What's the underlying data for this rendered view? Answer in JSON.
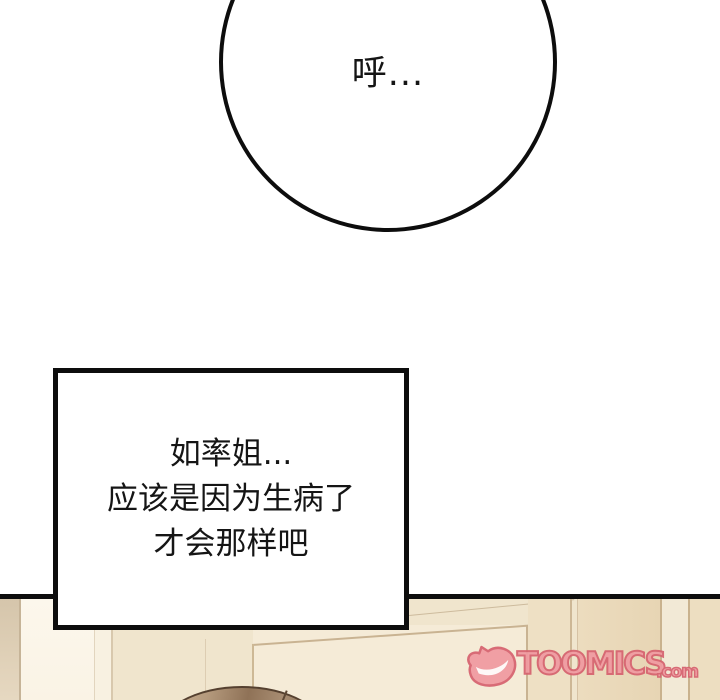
{
  "page": {
    "kind": "webtoon-comic-panel"
  },
  "panels": {
    "top": {
      "bubble_text": "呼..."
    }
  },
  "speech_box": {
    "lines": [
      "如率姐...",
      "应该是因为生病了",
      "才会那样吧"
    ]
  },
  "watermark": {
    "brand": "TOOMICS",
    "suffix": ".com",
    "icon": "toomics-d-smile-icon",
    "fill_color": "#f09aa1",
    "outline_color": "#d6626f"
  },
  "colors": {
    "ink": "#0d0d0d",
    "paper": "#ffffff",
    "wall_light": "#faf4e8",
    "wall_mid": "#f0e5cd",
    "wall_dark": "#e7d5b4",
    "hair_brown": "#8f7257"
  }
}
